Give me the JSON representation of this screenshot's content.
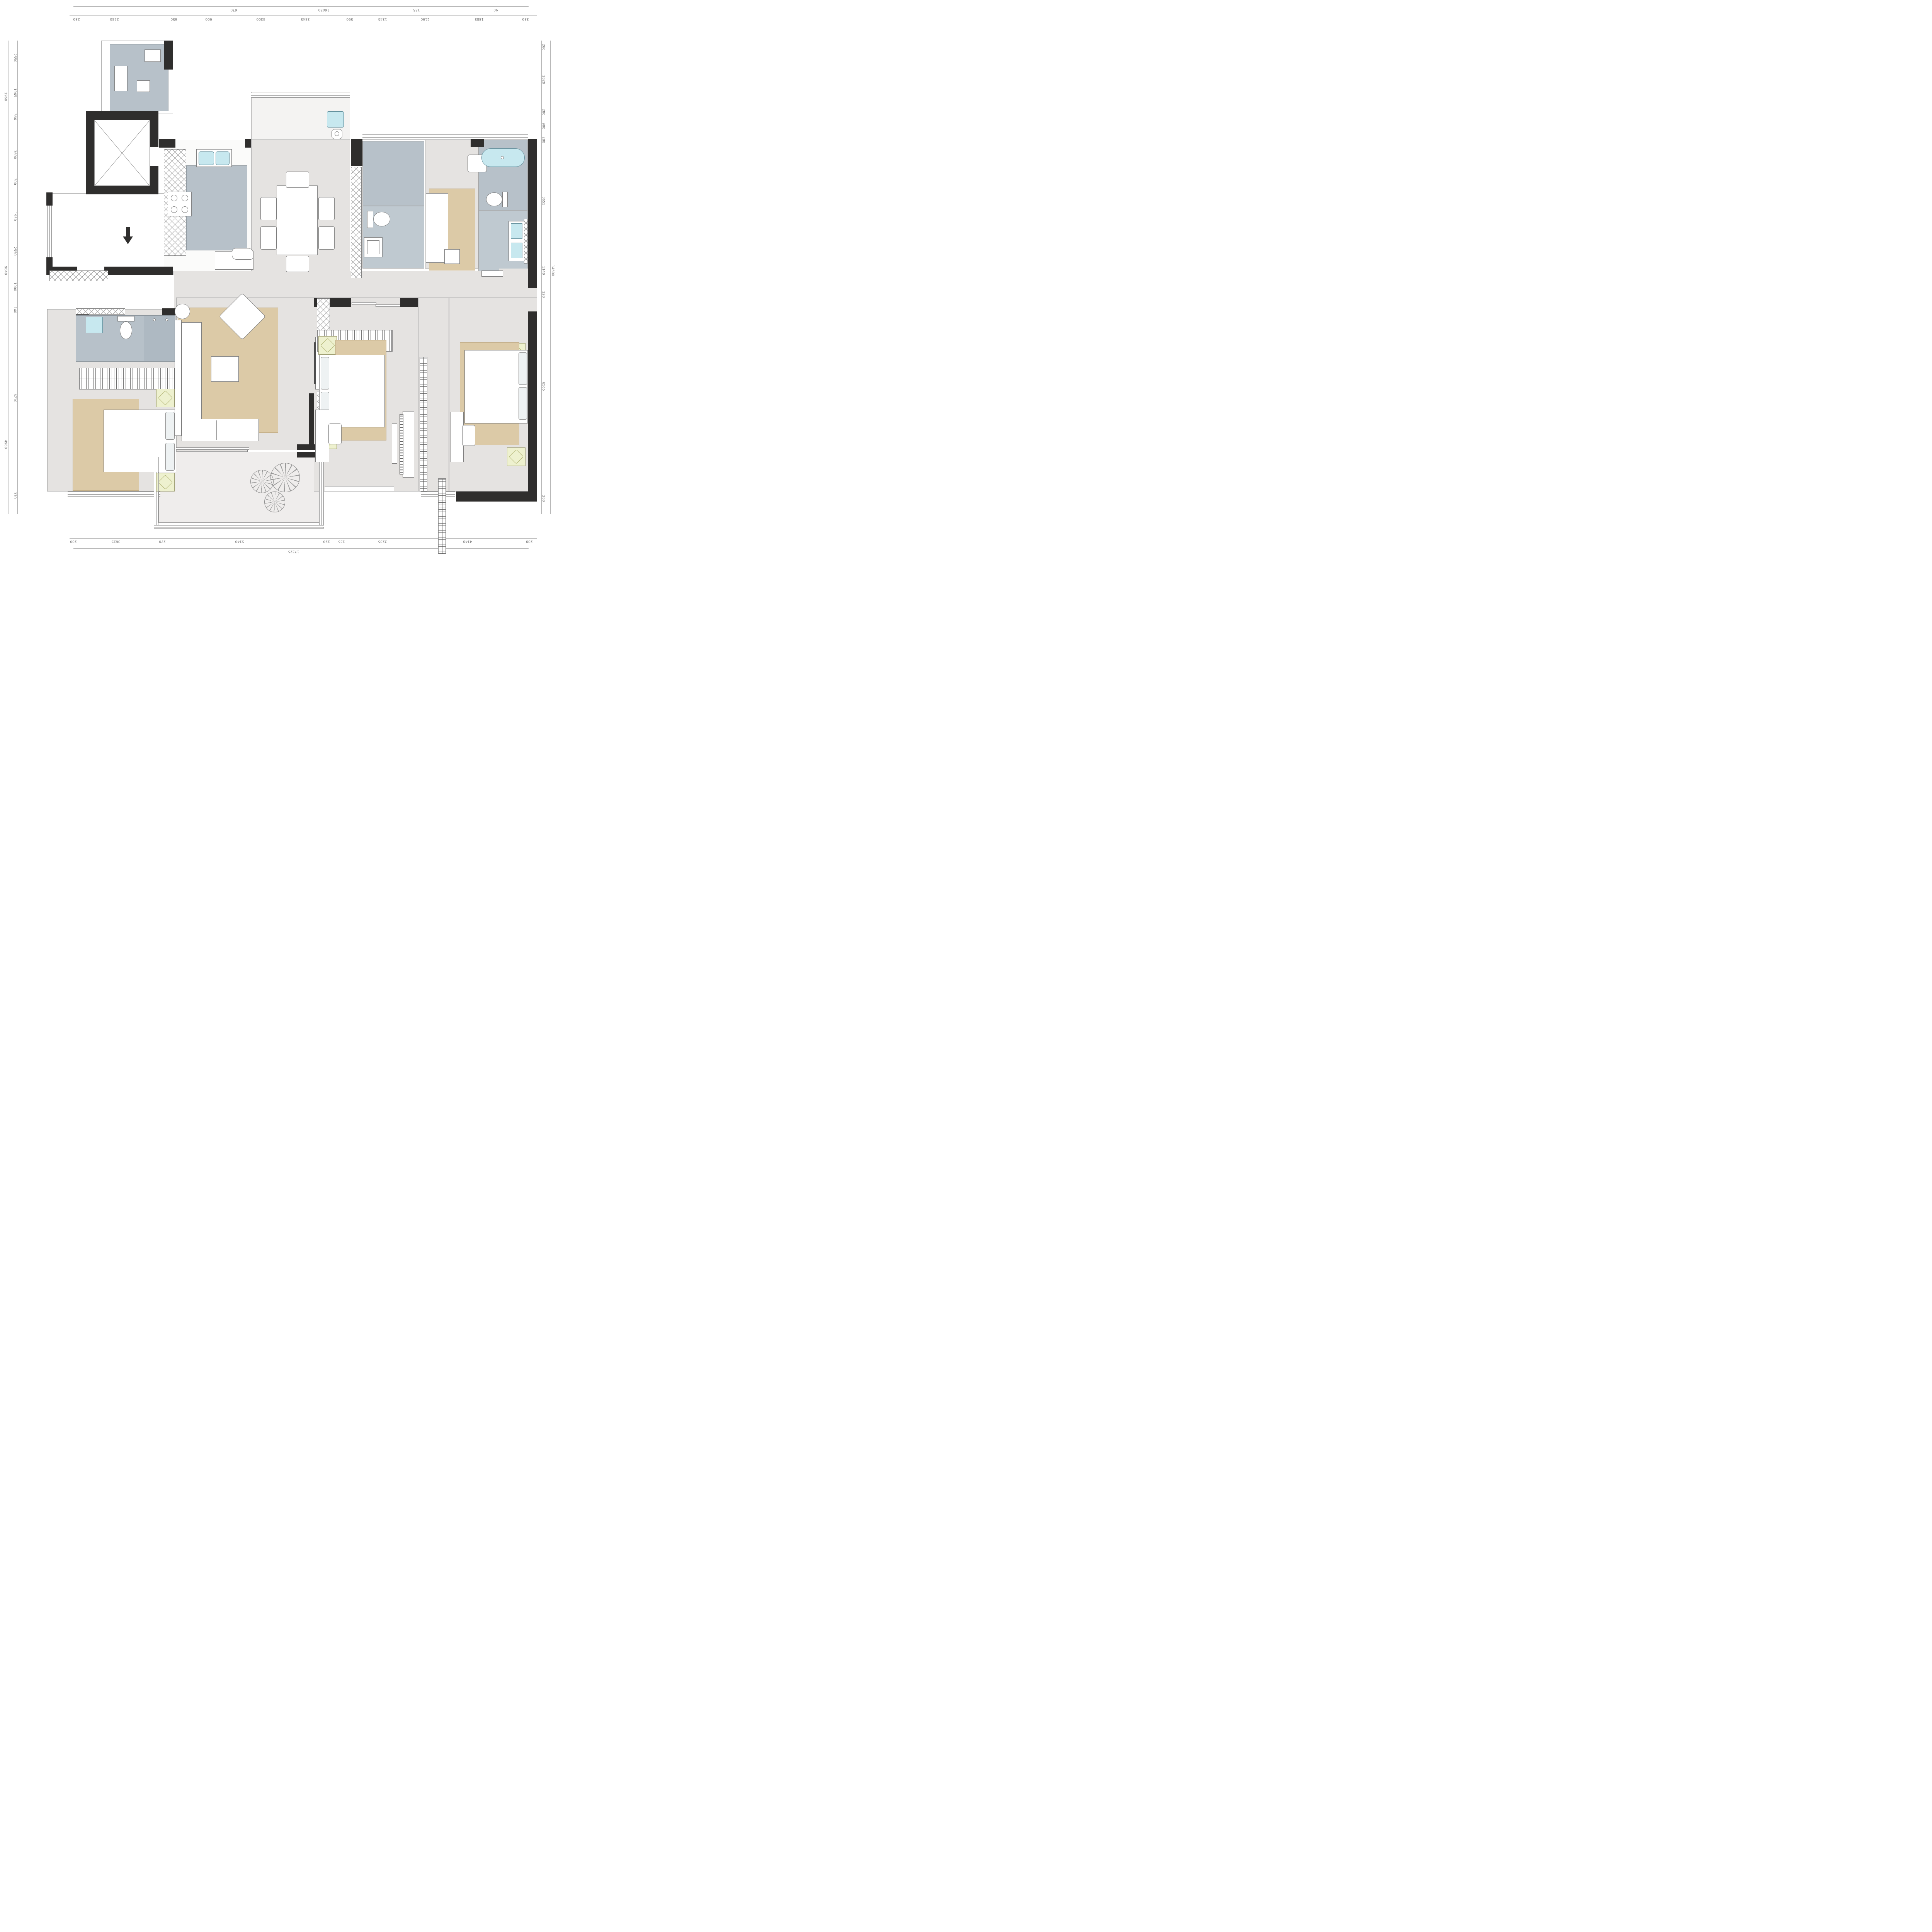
{
  "drawing": {
    "type": "residential-apartment-floor-plan",
    "units": "mm",
    "colors": {
      "wall": "#2f2e2d",
      "floor": "#e5e3e1",
      "wet_area": "#b7c1c9",
      "rug": "#dccaa7",
      "fixture_water": "#c7e8ef",
      "nightstand": "#eef1cf",
      "dimension_text": "#6e6e6e"
    }
  },
  "dimensions": {
    "top_outer": [
      "670",
      "16030",
      "135",
      "90"
    ],
    "top_inner": [
      "280",
      "2530",
      "650",
      "900",
      "3300",
      "3345",
      "590",
      "1345",
      "2190",
      "1885",
      "330"
    ],
    "left_outer": [
      "1960",
      "9840",
      "4980"
    ],
    "left_inner": [
      "2550",
      "1965",
      "366",
      "3690",
      "300",
      "1950",
      "2550",
      "1000",
      "140",
      "6710",
      "370"
    ],
    "right_outer": [
      "14600"
    ],
    "right_inner": [
      "260",
      "1820",
      "280",
      "900",
      "280",
      "3655",
      "1140",
      "120",
      "6565",
      "280"
    ],
    "bottom_outer": [
      "17325"
    ],
    "bottom_inner": [
      "280",
      "3625",
      "270",
      "5140",
      "220",
      "135",
      "3235",
      "4148",
      "288"
    ]
  }
}
